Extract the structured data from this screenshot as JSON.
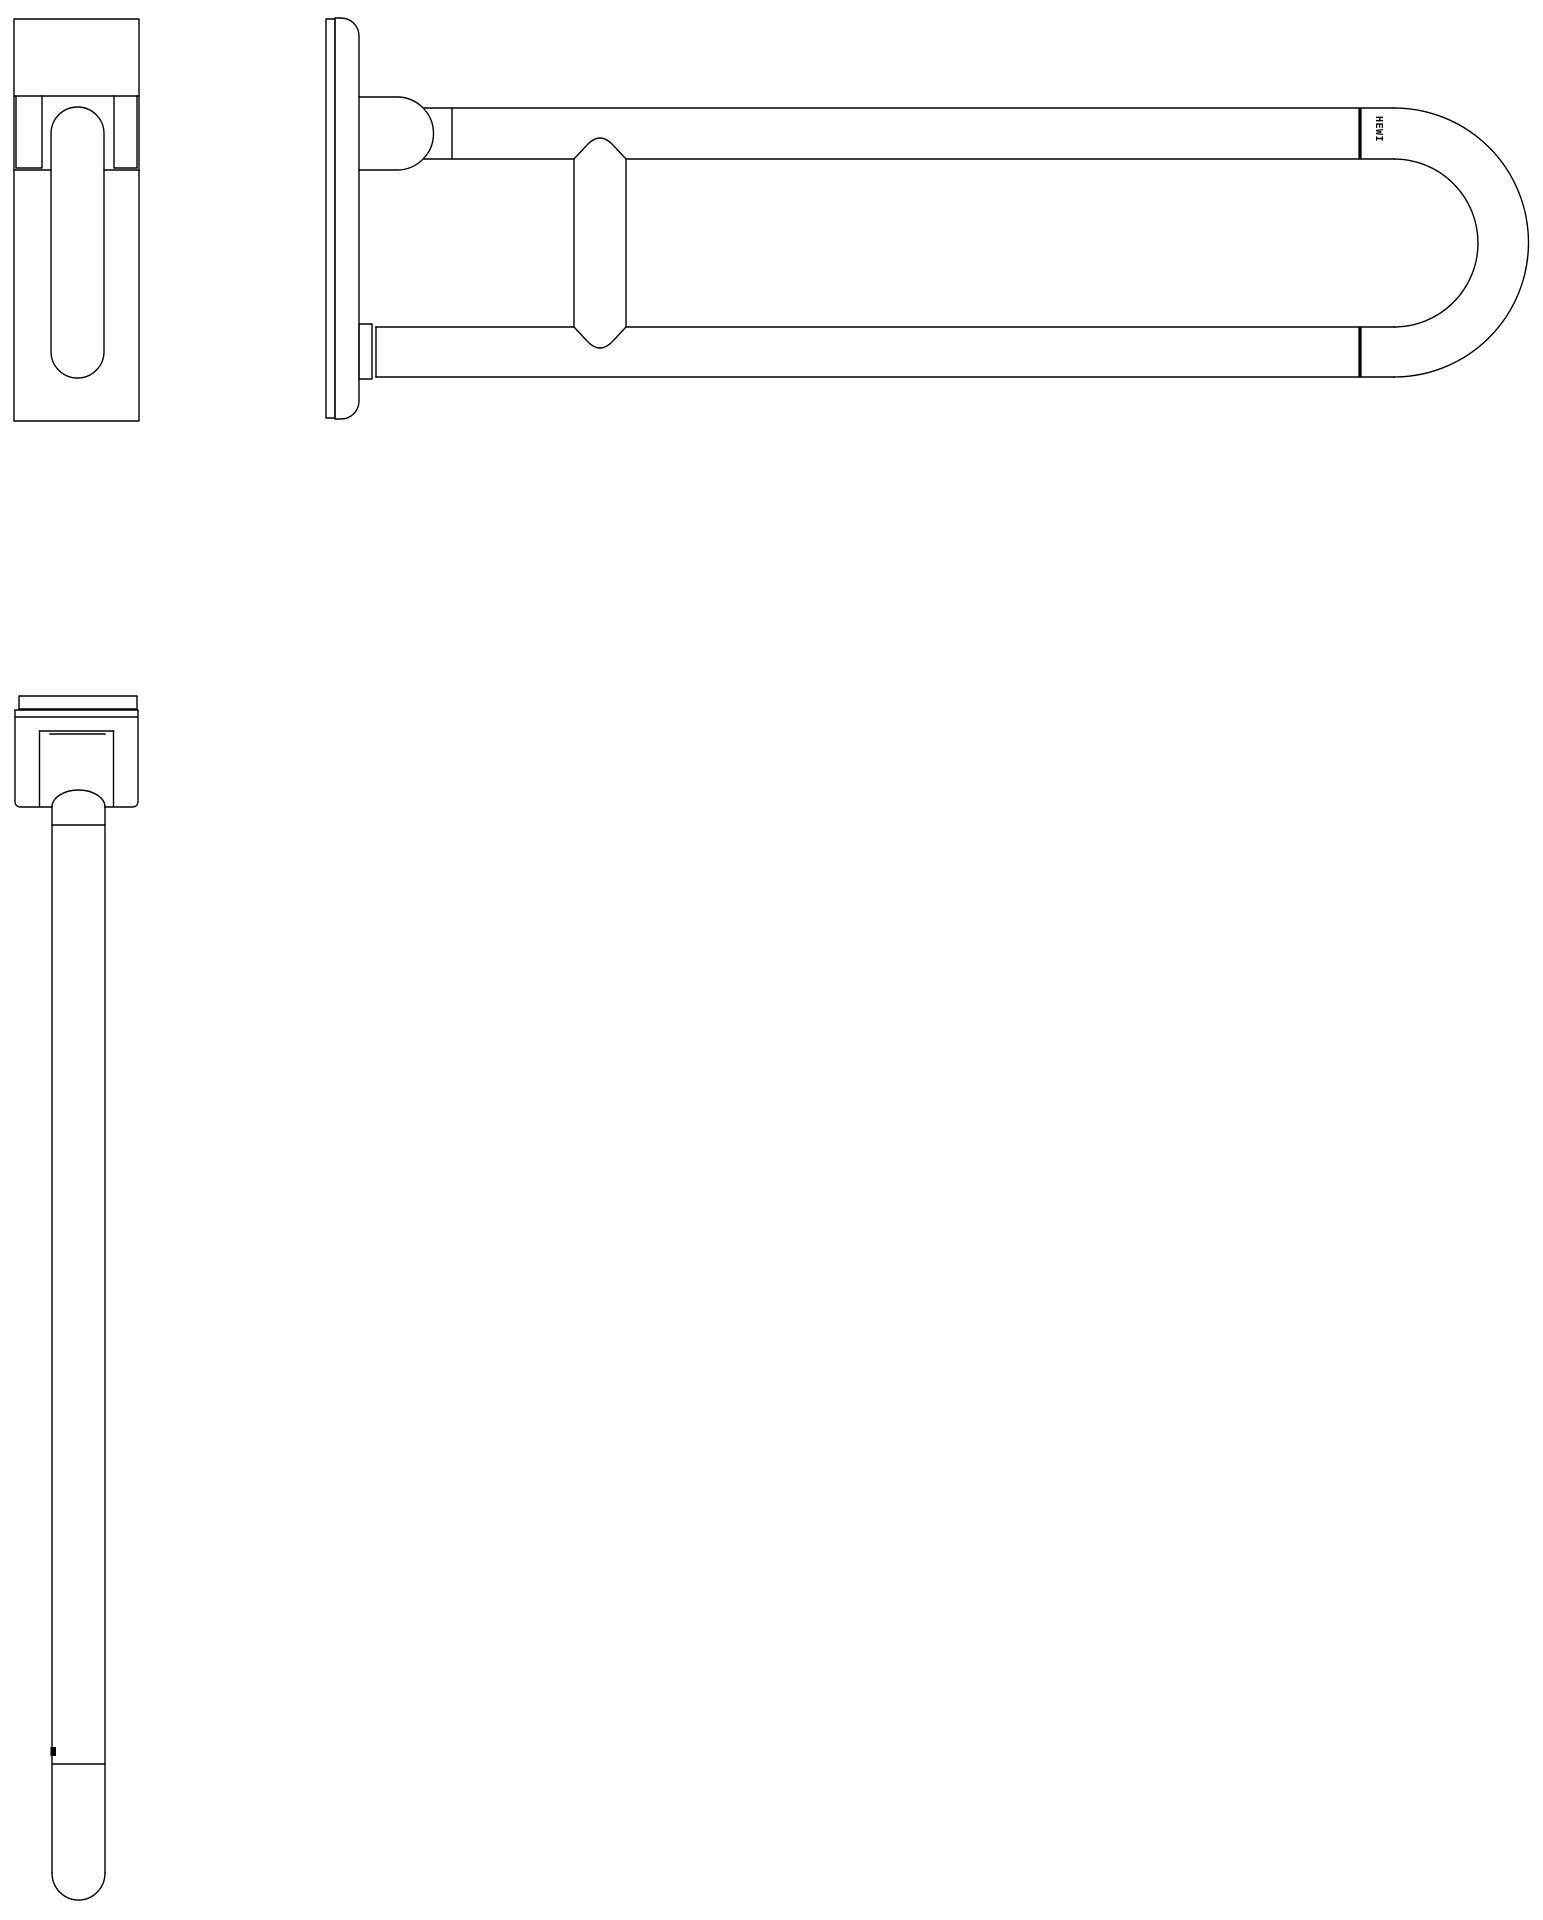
{
  "drawing": {
    "background_color": "#ffffff",
    "stroke_color": "#000000",
    "brand_label": "HEWI"
  }
}
